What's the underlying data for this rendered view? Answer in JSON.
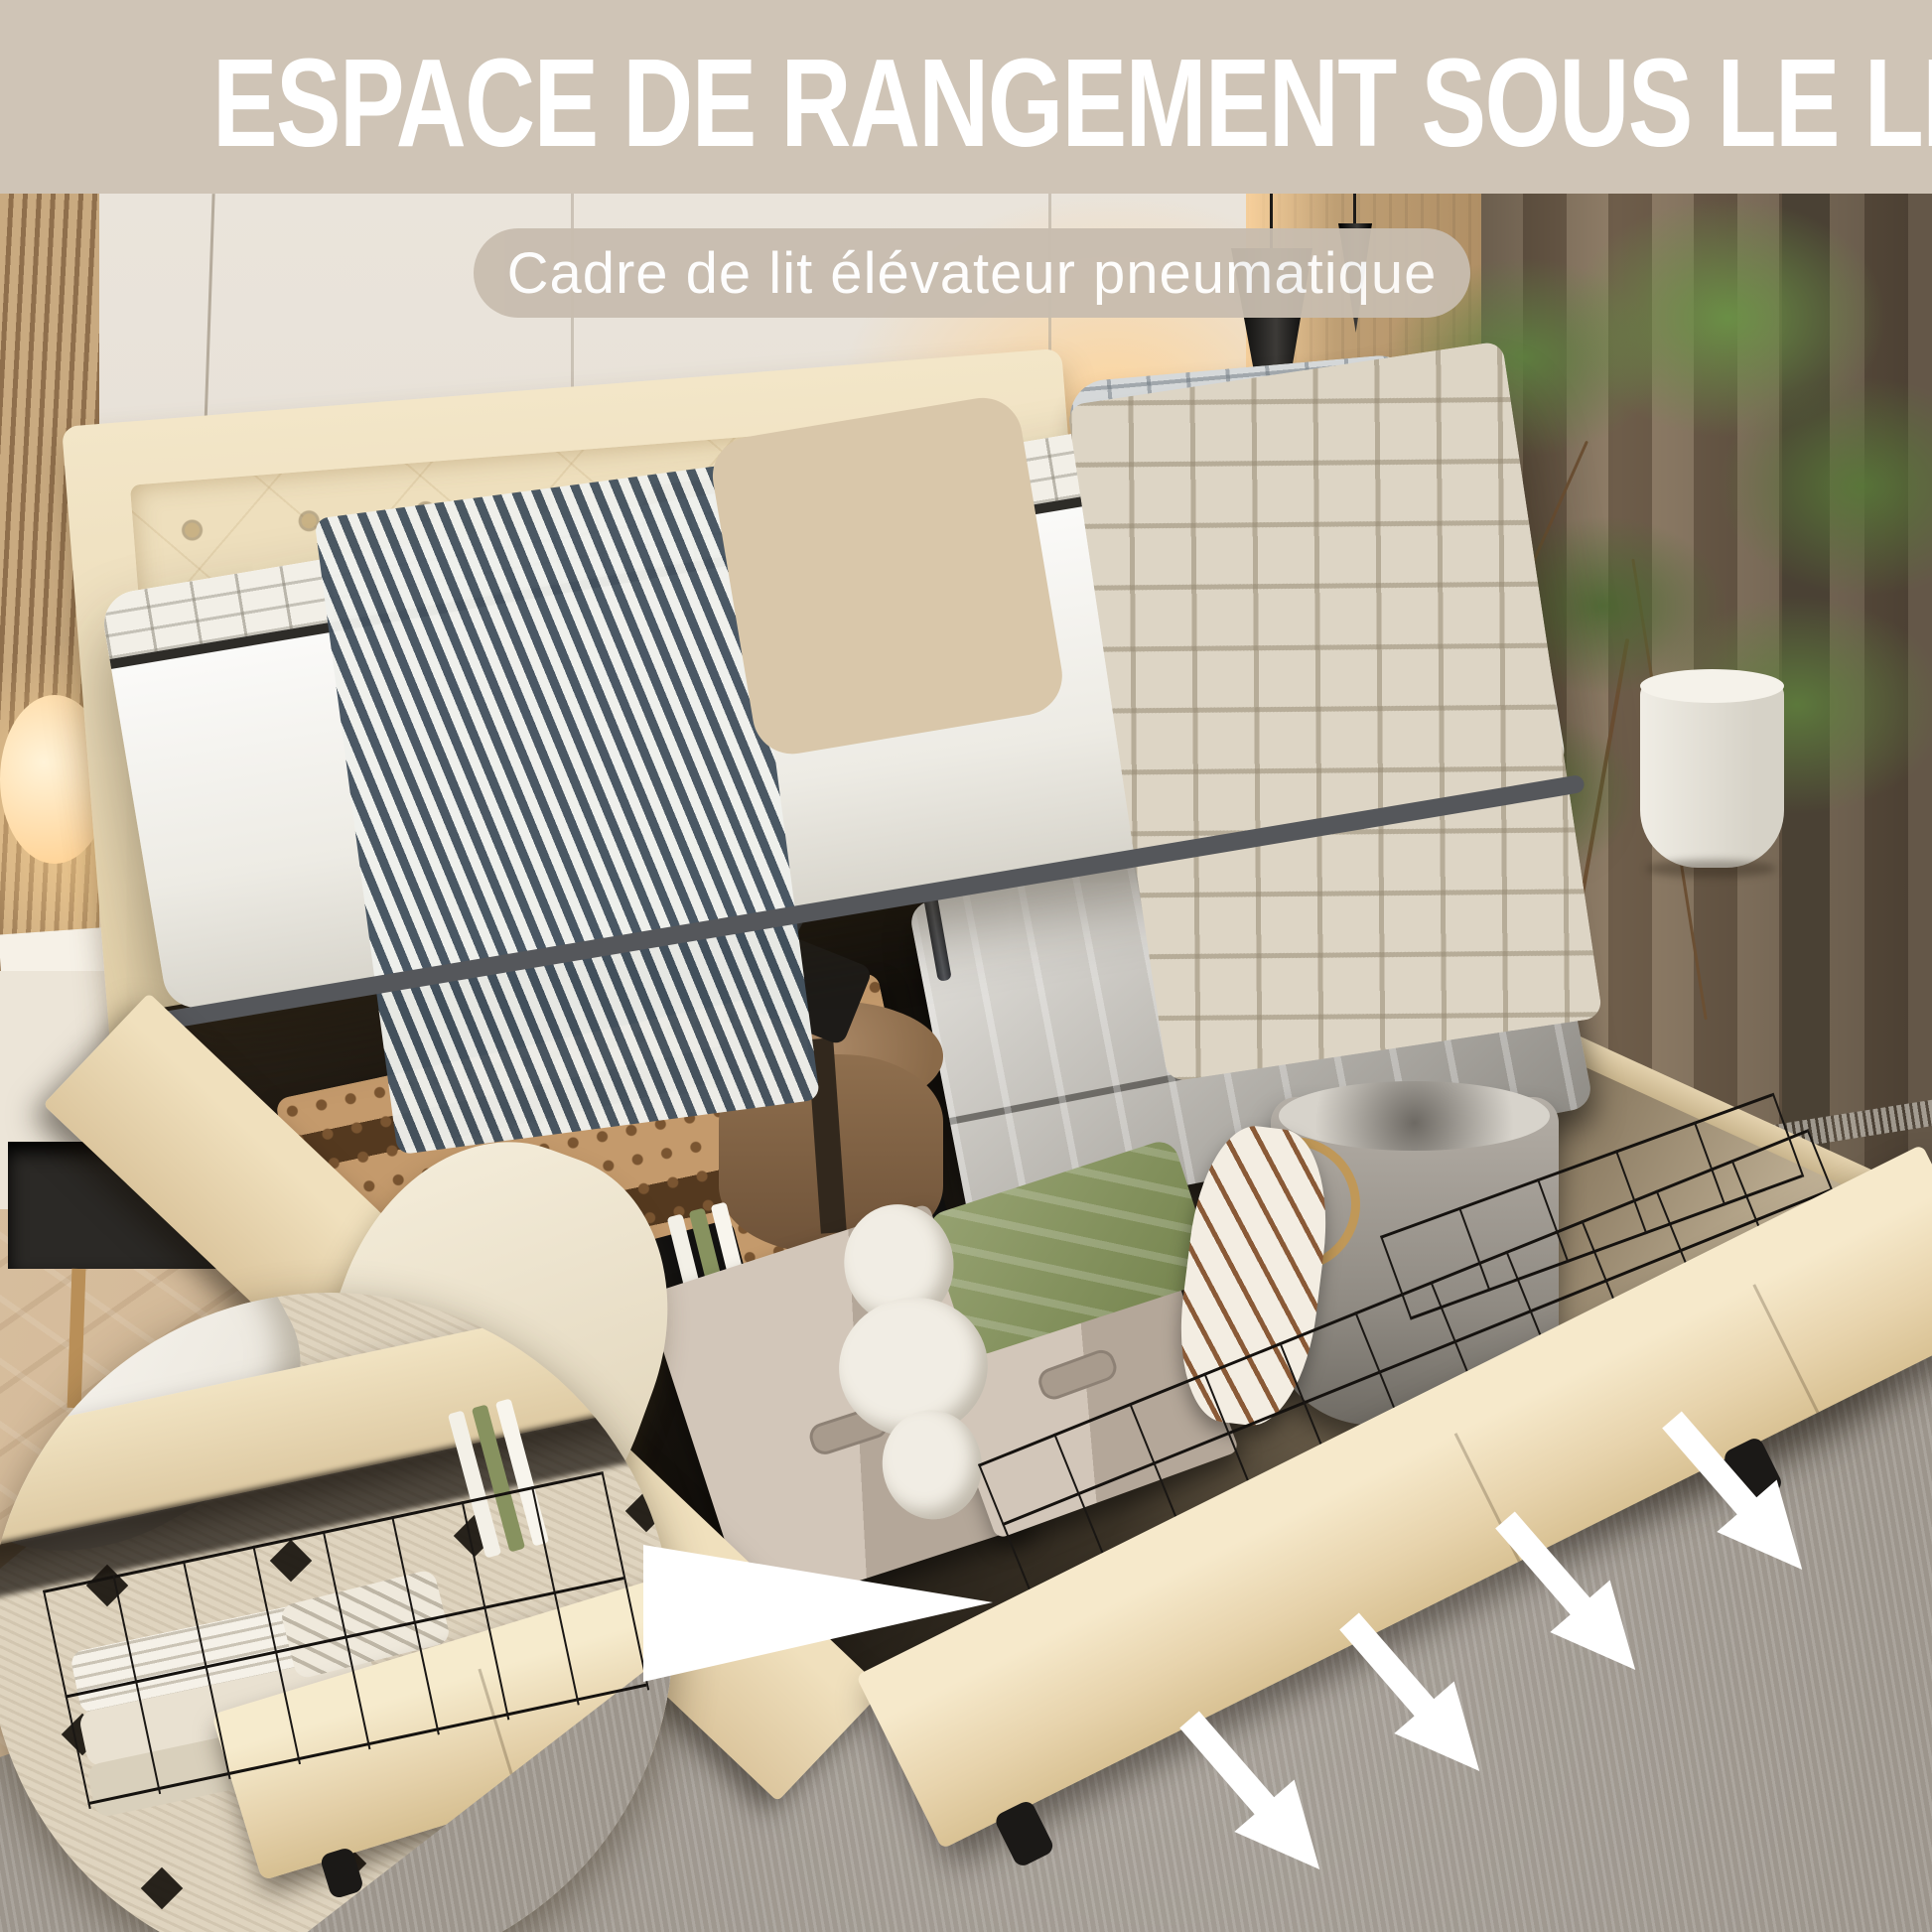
{
  "header": {
    "title": "ESPACE DE RANGEMENT SOUS LE LIT",
    "subtitle": "Cadre de lit élévateur pneumatique"
  },
  "scene": {
    "pillow_text_line1": "Dream",
    "pillow_text_line2": "Big"
  },
  "icons": {
    "callout": "callout-wedge-icon",
    "arrow": "arrow-down-right-icon"
  },
  "colors": {
    "band": "#cfc4b6",
    "pill": "#c8bdaf",
    "txt": "#ffffff",
    "wall": "#eae4db",
    "seam": "#b5ab9c",
    "slat1": "#c9aa80",
    "slat2": "#8f6f4c",
    "wood1": "#c8a97e",
    "wood2": "#97744b",
    "curt1": "#8f7d67",
    "curt2": "#6e5d4a",
    "floor1": "#d8bf9f",
    "floor2": "#bb9d78",
    "rug": "#9c958c",
    "rugLt": "#b3ada3",
    "fab1": "#f2e4c6",
    "fab2": "#dfcaa2",
    "dark": "#17130e",
    "metal": "#55575b",
    "gold": "#c09858",
    "green1": "#96a271",
    "green2": "#75844e",
    "chev": "#44525f",
    "plant1": "#5f8040",
    "plant2": "#3f5e2c",
    "arrow": "#ffffff"
  }
}
